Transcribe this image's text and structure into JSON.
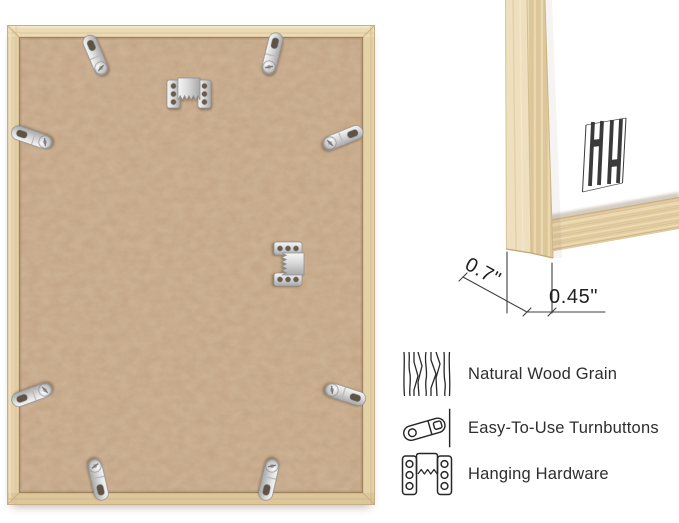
{
  "dimensions": {
    "frame_depth": "0.7\"",
    "frame_face_width": "0.45\""
  },
  "features": [
    {
      "icon": "wood-grain-icon",
      "label": "Natural Wood Grain"
    },
    {
      "icon": "turnbutton-icon",
      "label": "Easy-To-Use Turnbuttons"
    },
    {
      "icon": "hanging-hardware-icon",
      "label": "Hanging Hardware"
    }
  ],
  "hardware": {
    "turnbutton_count": 8,
    "sawtooth_hanger_count": 2
  },
  "colors": {
    "wood": "#e4d0a7",
    "mdf_board": "#c7a685",
    "metal": "#d7d7d7",
    "label_text": "#2e2e2e",
    "logo": "#3a3a3a",
    "dimension_text": "#1f1f1f"
  }
}
